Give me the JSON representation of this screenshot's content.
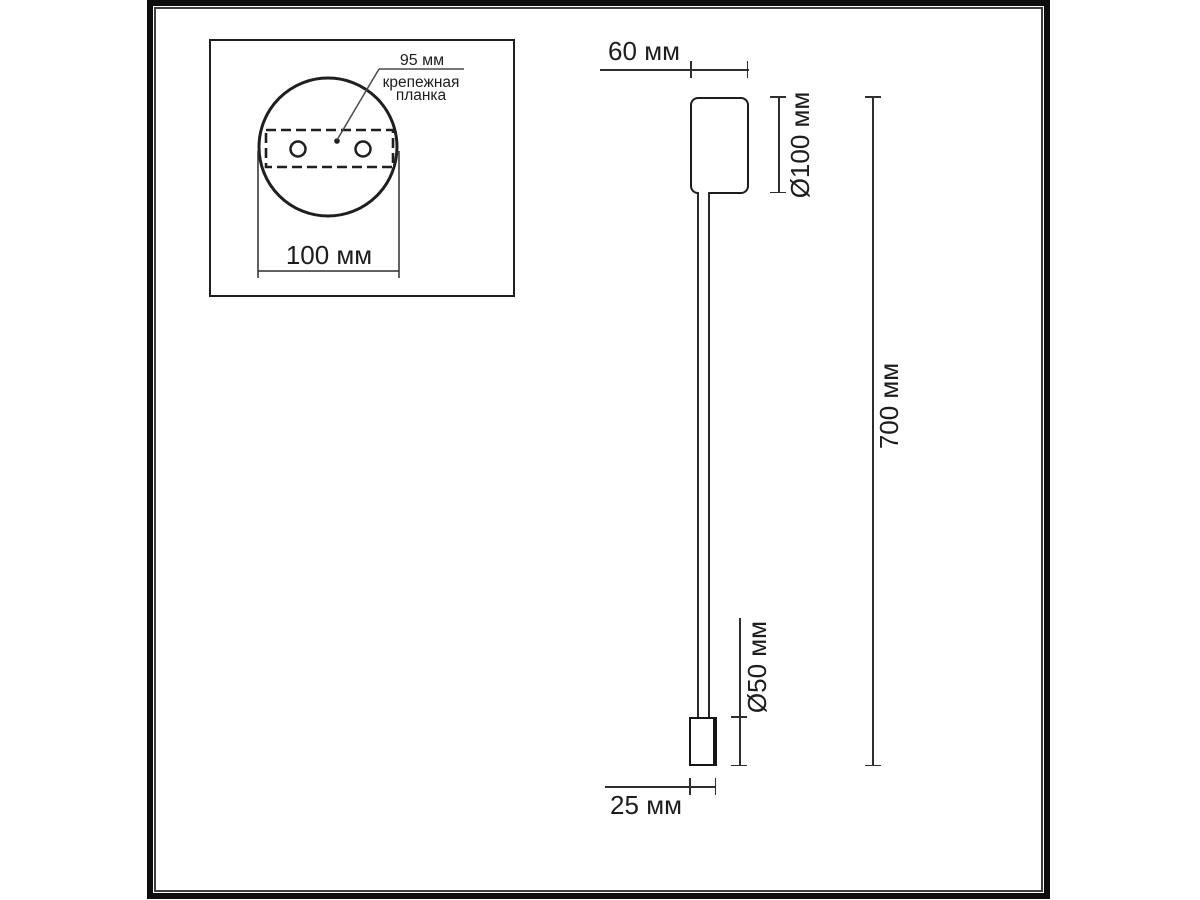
{
  "diagram": {
    "top_view": {
      "hole_spacing_label": "95 мм",
      "plate_name_line1": "крепежная",
      "plate_name_line2": "планка",
      "base_width_label": "100 мм"
    },
    "side_view": {
      "base_depth_label": "60 мм",
      "base_diameter_label": "Ø100 мм",
      "overall_height_label": "700 мм",
      "head_length_label": "Ø50 мм",
      "head_width_label": "25 мм"
    },
    "colors": {
      "object_line": "#1c1c1c",
      "dimension_line": "#2e2e2e",
      "frame": "#0d0d0d",
      "background": "#ffffff"
    }
  }
}
